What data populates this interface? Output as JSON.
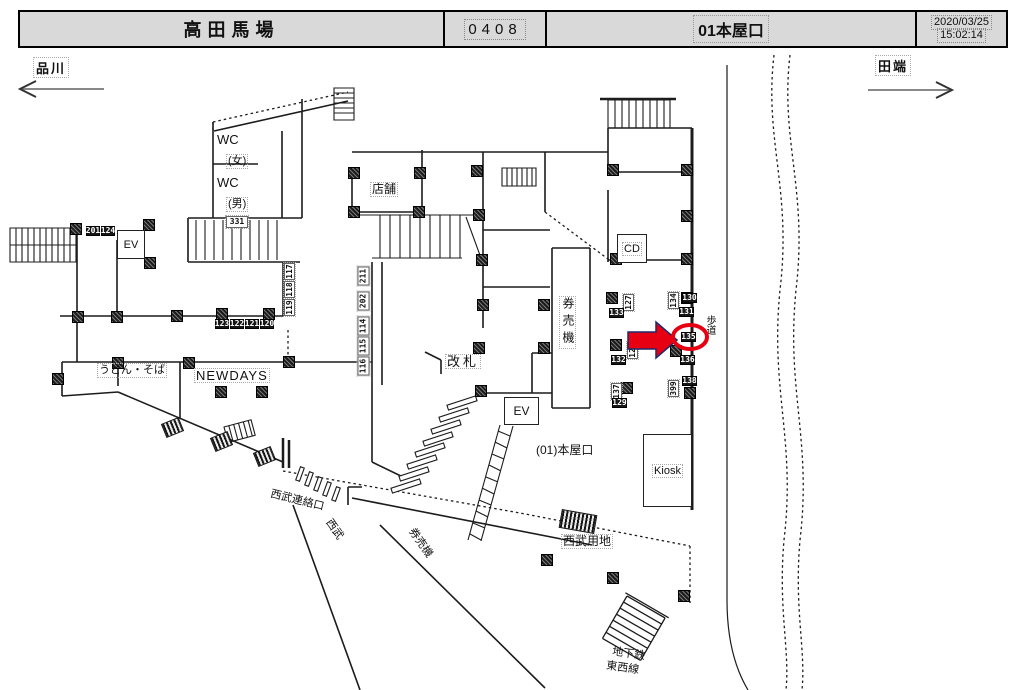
{
  "header": {
    "station": "高田馬場",
    "code": "0408",
    "exit": "01本屋口",
    "date": "2020/03/25",
    "time": "15:02:14"
  },
  "directions": {
    "left": "品川",
    "right": "田端"
  },
  "colors": {
    "accent_red": "#e60012",
    "arrow_outline": "#1f2a6b",
    "header_bg": "#d9d9d9",
    "wall": "#1c1c1c"
  },
  "map": {
    "labels": {
      "wc_women": "WC",
      "wc_women_sub": "(女)",
      "wc_men": "WC",
      "wc_men_sub": "(男)",
      "ev_left": "EV",
      "ev_center": "EV",
      "shop": "店舗",
      "ticket_gate": "改札",
      "ticket_machines": "券売機",
      "exit_name": "(01)本屋口",
      "kiosk": "Kiosk",
      "cd": "CD",
      "sidewalk": "歩道",
      "udon_soba": "うどん・そば",
      "newdays": "NEWDAYS",
      "seibu_connection": "西武連絡口",
      "seibu": "西武",
      "seibu_ticket_machines": "券売機",
      "seibu_property": "西武用地",
      "subway_line1": "地下鉄",
      "subway_line2": "東西線"
    },
    "selection": {
      "circled_tag": "135",
      "arrow_direction": "right"
    },
    "tags": [
      {
        "t": "201",
        "x": 86,
        "y": 226,
        "style": "dark",
        "w": 14,
        "h": 10
      },
      {
        "t": "124",
        "x": 101,
        "y": 226,
        "style": "dark",
        "w": 14,
        "h": 10
      },
      {
        "t": "331",
        "x": 226,
        "y": 216,
        "style": "light",
        "w": 22,
        "h": 12
      },
      {
        "t": "123",
        "x": 215,
        "y": 319,
        "style": "dark",
        "w": 14,
        "h": 10
      },
      {
        "t": "122",
        "x": 230,
        "y": 319,
        "style": "dark",
        "w": 14,
        "h": 10
      },
      {
        "t": "121",
        "x": 245,
        "y": 319,
        "style": "dark",
        "w": 14,
        "h": 10
      },
      {
        "t": "120",
        "x": 260,
        "y": 319,
        "style": "dark",
        "w": 14,
        "h": 10
      },
      {
        "t": "117",
        "x": 284,
        "y": 263,
        "style": "light",
        "vert": true,
        "w": 17,
        "h": 11
      },
      {
        "t": "118",
        "x": 284,
        "y": 281,
        "style": "light",
        "vert": true,
        "w": 17,
        "h": 11
      },
      {
        "t": "119",
        "x": 284,
        "y": 299,
        "style": "light",
        "vert": true,
        "w": 17,
        "h": 11
      },
      {
        "t": "211",
        "x": 357,
        "y": 266,
        "style": "light",
        "vert": true,
        "w": 19,
        "h": 12
      },
      {
        "t": "202",
        "x": 357,
        "y": 291,
        "style": "light",
        "vert": true,
        "w": 19,
        "h": 12
      },
      {
        "t": "114",
        "x": 357,
        "y": 316,
        "style": "light",
        "vert": true,
        "w": 19,
        "h": 12
      },
      {
        "t": "115",
        "x": 357,
        "y": 336,
        "style": "light",
        "vert": true,
        "w": 19,
        "h": 12
      },
      {
        "t": "116",
        "x": 357,
        "y": 356,
        "style": "light",
        "vert": true,
        "w": 19,
        "h": 12
      },
      {
        "t": "127",
        "x": 623,
        "y": 294,
        "style": "light",
        "vert": true,
        "w": 17,
        "h": 11
      },
      {
        "t": "133",
        "x": 609,
        "y": 308,
        "style": "dark",
        "w": 15,
        "h": 10
      },
      {
        "t": "128",
        "x": 627,
        "y": 342,
        "style": "light",
        "vert": true,
        "w": 17,
        "h": 11
      },
      {
        "t": "132",
        "x": 611,
        "y": 355,
        "style": "dark",
        "w": 15,
        "h": 10
      },
      {
        "t": "137",
        "x": 611,
        "y": 383,
        "style": "light",
        "vert": true,
        "w": 17,
        "h": 11
      },
      {
        "t": "129",
        "x": 612,
        "y": 398,
        "style": "dark",
        "w": 15,
        "h": 10
      },
      {
        "t": "134",
        "x": 668,
        "y": 292,
        "style": "light",
        "vert": true,
        "w": 17,
        "h": 11
      },
      {
        "t": "130",
        "x": 682,
        "y": 293,
        "style": "dark",
        "w": 15,
        "h": 10
      },
      {
        "t": "131",
        "x": 679,
        "y": 307,
        "style": "dark",
        "w": 15,
        "h": 10
      },
      {
        "t": "135",
        "x": 681,
        "y": 332,
        "style": "dark",
        "w": 15,
        "h": 10
      },
      {
        "t": "136",
        "x": 680,
        "y": 355,
        "style": "dark",
        "w": 15,
        "h": 10
      },
      {
        "t": "399",
        "x": 668,
        "y": 380,
        "style": "light",
        "vert": true,
        "w": 17,
        "h": 11
      },
      {
        "t": "138",
        "x": 682,
        "y": 376,
        "style": "dark",
        "w": 15,
        "h": 10
      }
    ],
    "markers": [
      [
        75,
        228
      ],
      [
        148,
        224
      ],
      [
        149,
        262
      ],
      [
        77,
        316
      ],
      [
        116,
        316
      ],
      [
        176,
        315
      ],
      [
        221,
        313
      ],
      [
        268,
        313
      ],
      [
        57,
        378
      ],
      [
        117,
        362
      ],
      [
        188,
        362
      ],
      [
        288,
        361
      ],
      [
        220,
        391
      ],
      [
        261,
        391
      ],
      [
        353,
        172
      ],
      [
        419,
        172
      ],
      [
        353,
        211
      ],
      [
        418,
        211
      ],
      [
        476,
        170
      ],
      [
        478,
        214
      ],
      [
        481,
        259
      ],
      [
        482,
        304
      ],
      [
        478,
        347
      ],
      [
        480,
        390
      ],
      [
        543,
        304
      ],
      [
        543,
        347
      ],
      [
        612,
        169
      ],
      [
        686,
        169
      ],
      [
        686,
        215
      ],
      [
        615,
        258
      ],
      [
        686,
        258
      ],
      [
        611,
        297
      ],
      [
        615,
        344
      ],
      [
        626,
        387
      ],
      [
        686,
        297
      ],
      [
        675,
        350
      ],
      [
        689,
        392
      ],
      [
        546,
        559
      ],
      [
        612,
        577
      ],
      [
        683,
        595
      ]
    ],
    "hatches": [
      {
        "x": 560,
        "y": 512,
        "w": 34,
        "h": 17,
        "rot": 10
      },
      {
        "x": 163,
        "y": 420,
        "w": 17,
        "h": 13,
        "rot": -22
      },
      {
        "x": 212,
        "y": 434,
        "w": 17,
        "h": 13,
        "rot": -22
      },
      {
        "x": 255,
        "y": 449,
        "w": 17,
        "h": 13,
        "rot": -22
      }
    ]
  }
}
